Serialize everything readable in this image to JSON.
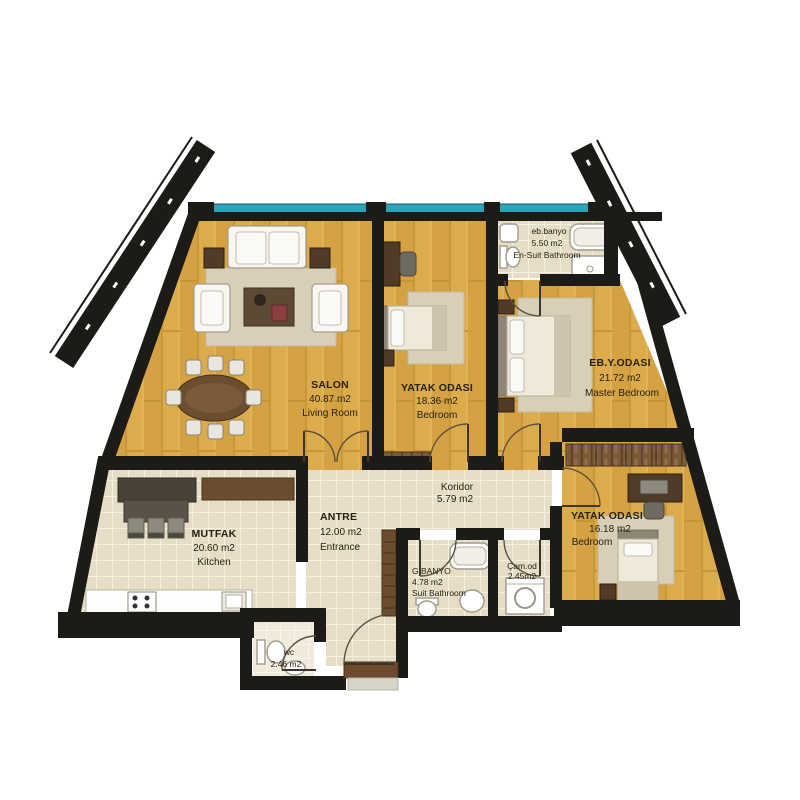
{
  "colors": {
    "wall": "#1d1b18",
    "wood_floor": "#dcab4c",
    "tile_floor": "#e5ddc6",
    "window_band": "#2ba4ba",
    "rug": "#d8cfb8",
    "furniture_wood": "#6b4c2e",
    "fixture_white": "#ffffff"
  },
  "rooms": {
    "salon": {
      "name": "SALON",
      "area": "40.87 m2",
      "alt": "Living Room"
    },
    "bedroom1": {
      "name": "YATAK ODASI",
      "area": "18.36 m2",
      "alt": "Bedroom"
    },
    "master": {
      "name": "EB.Y.ODASI",
      "area": "21.72 m2",
      "alt": "Master Bedroom"
    },
    "ensuite": {
      "name": "eb.banyo",
      "area": "5.50 m2",
      "alt": "En-Suit Bathroom"
    },
    "kitchen": {
      "name": "MUTFAK",
      "area": "20.60 m2",
      "alt": "Kitchen"
    },
    "entrance": {
      "name": "ANTRE",
      "area": "12.00 m2",
      "alt": "Entrance"
    },
    "corridor": {
      "name": "Koridor",
      "area": "5.79 m2"
    },
    "bathroom": {
      "name": "G.BANYO",
      "area": "4.78 m2",
      "alt": "Suit Bathroom"
    },
    "laundry": {
      "name": "Çam.od",
      "area": "2.45m2"
    },
    "bedroom2": {
      "name": "YATAK ODASI",
      "area": "16.18 m2",
      "alt": "Bedroom"
    },
    "wc": {
      "name": "wc",
      "area": "2.46 m2"
    }
  }
}
